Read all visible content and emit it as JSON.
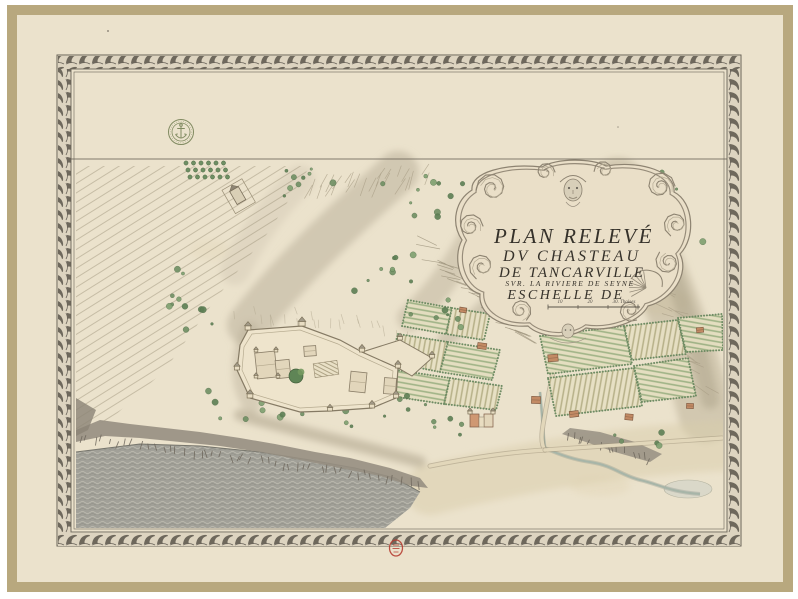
{
  "map": {
    "cartouche": {
      "title_line1": "PLAN RELEVÉ",
      "title_line2": "DV CHASTEAU",
      "title_line3": "DE TANCARVILLE",
      "subtitle": "SVR. LA RIVIERE DE SEYNE",
      "scale_label": "ESCHELLE DE",
      "scale_ticks": [
        "10",
        "20",
        "30. Thoises"
      ]
    },
    "stamps": {
      "library_seal_icon": "anchor-seal-icon",
      "collection_stamp_icon": "red-oval-stamp-icon"
    },
    "colors": {
      "paper": "#ebe2cc",
      "paper_edge": "#b8a87e",
      "border_ink": "#555046",
      "ink": "#5a544a",
      "water_gray": "#a1a098",
      "vegetation_green": "#6f8f63",
      "roof_ochre": "#c28a64",
      "seal_green": "#6e7b4e",
      "stamp_red": "#b53a2e"
    }
  }
}
